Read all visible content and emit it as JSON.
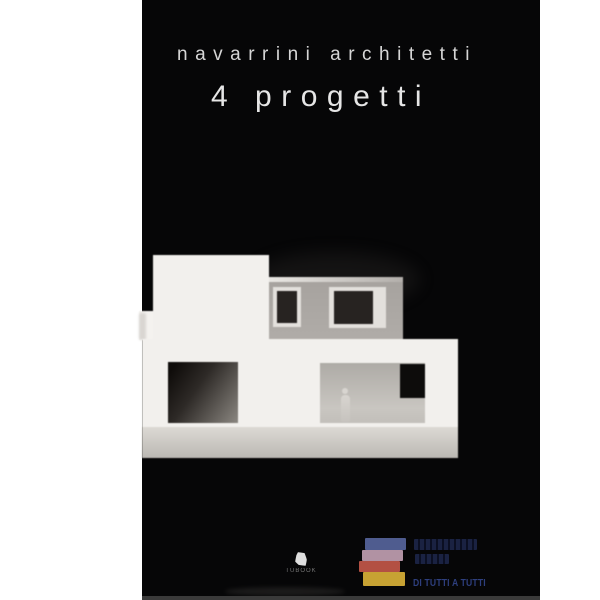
{
  "cover": {
    "title_line1": "navarrini architetti",
    "title_line2": "4 progetti"
  },
  "publisher_logo": {
    "slogan": "DI TUTTI A TUTTI",
    "book_colors": [
      "#4f5c8f",
      "#b192a3",
      "#b35043",
      "#c7a233"
    ],
    "wordmark_color": "#151b36",
    "slogan_color": "#2e3f7e"
  },
  "imprint": {
    "label": "TUBOOK"
  },
  "colors": {
    "page_background": "#ffffff",
    "cover_background": "#060607",
    "title_text": "#d6d6d6",
    "model_white": "#f2f0ed",
    "model_upper_gray": "#a9a5a1",
    "model_window_dark": "#272321",
    "model_ground": "#cfccc7"
  }
}
